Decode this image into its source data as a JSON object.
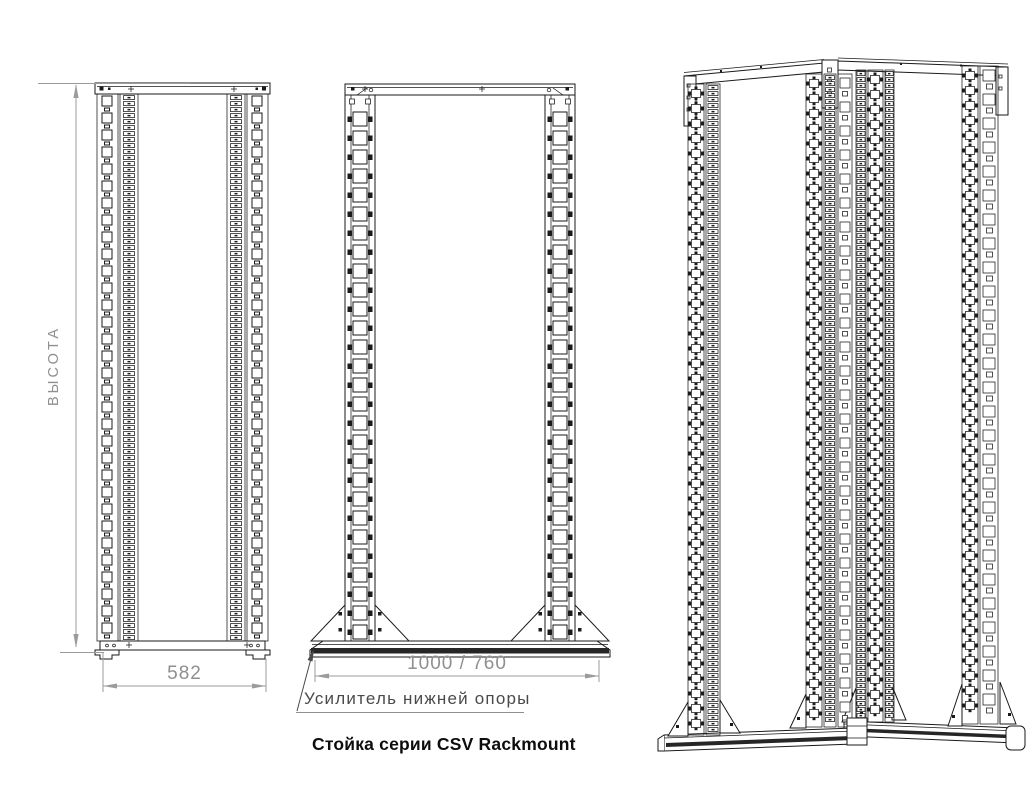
{
  "drawing": {
    "caption": "Стойка серии CSV Rackmount",
    "leader_note": "Усилитель нижней опоры",
    "dimensions": {
      "height_label": "ВЫСОТА",
      "front_width": "582",
      "base_length": "1000 / 760"
    },
    "colors": {
      "line": "#1a1a1a",
      "dimension": "#9b9b9b",
      "dimension_text": "#8f8f8f",
      "leader": "#4a4a4a",
      "caption": "#0d0d0d",
      "reinforcement": "#262626",
      "background": "#ffffff"
    }
  }
}
